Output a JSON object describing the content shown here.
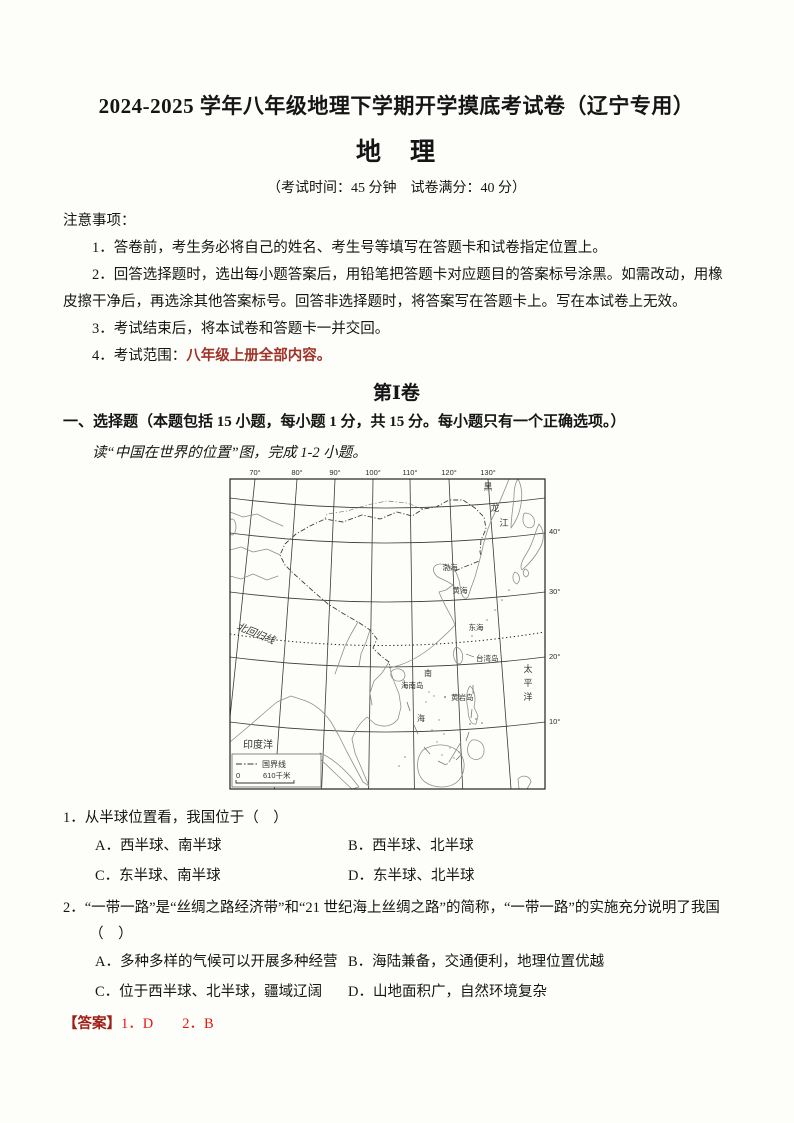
{
  "header": {
    "title": "2024-2025 学年八年级地理下学期开学摸底考试卷（辽宁专用）",
    "subject": "地　理",
    "exam_info": "（考试时间：45 分钟　试卷满分：40 分）"
  },
  "notice": {
    "heading": "注意事项：",
    "item1": "1．答卷前，考生务必将自己的姓名、考生号等填写在答题卡和试卷指定位置上。",
    "item2": "2．回答选择题时，选出每小题答案后，用铅笔把答题卡对应题目的答案标号涂黑。如需改动，用橡皮擦干净后，再选涂其他答案标号。回答非选择题时，将答案写在答题卡上。写在本试卷上无效。",
    "item3": "3．考试结束后，将本试卷和答题卡一并交回。",
    "item4_label": "4．考试范围：",
    "item4_scope": "八年级上册全部内容。"
  },
  "part1": {
    "title": "第Ⅰ卷",
    "section_heading": "一、选择题（本题包括 15 小题，每小题 1 分，共 15 分。每小题只有一个正确选项。）",
    "intro": "读“中国在世界的位置”图，完成 1-2 小题。"
  },
  "map": {
    "lon_labels": [
      "70°",
      "80°",
      "90°",
      "100°",
      "110°",
      "120°",
      "130°"
    ],
    "lat_labels": [
      "40°",
      "30°",
      "20°",
      "10°"
    ],
    "river_char1": "黑",
    "river_char2": "龙",
    "river_char3": "江",
    "pacific_char1": "太",
    "pacific_char2": "平",
    "pacific_char3": "洋",
    "sea_bohai": "渤海",
    "sea_yellow": "黄海",
    "sea_east": "东海",
    "sea_south_1": "南",
    "sea_south_2": "海",
    "island_taiwan": "台湾岛",
    "island_hainan": "海南岛",
    "island_huangyan": "黄岩岛",
    "indian_ocean": "印度洋",
    "tropic_label": "北回归线",
    "legend_border_label": "国界线",
    "scale_zero": "0",
    "scale_km": "610千米"
  },
  "questions": {
    "q1": {
      "number": "1．",
      "stem": "从半球位置看，我国位于（　）",
      "optA_label": "A．",
      "optA": "西半球、南半球",
      "optB_label": "B．",
      "optB": "西半球、北半球",
      "optC_label": "C．",
      "optC": "东半球、南半球",
      "optD_label": "D．",
      "optD": "东半球、北半球"
    },
    "q2": {
      "number": "2．",
      "stem": "“一带一路”是“丝绸之路经济带”和“21 世纪海上丝绸之路”的简称，“一带一路”的实施充分说明了我国",
      "stem_cont": "（　）",
      "optA_label": "A．",
      "optA": "多种多样的气候可以开展多种经营",
      "optB_label": "B．",
      "optB": "海陆兼备，交通便利，地理位置优越",
      "optC_label": "C．",
      "optC": "位于西半球、北半球，疆域辽阔",
      "optD_label": "D．",
      "optD": "山地面积广，自然环境复杂"
    }
  },
  "answer": {
    "label": "【答案】",
    "text": "1．D　　2．B"
  }
}
